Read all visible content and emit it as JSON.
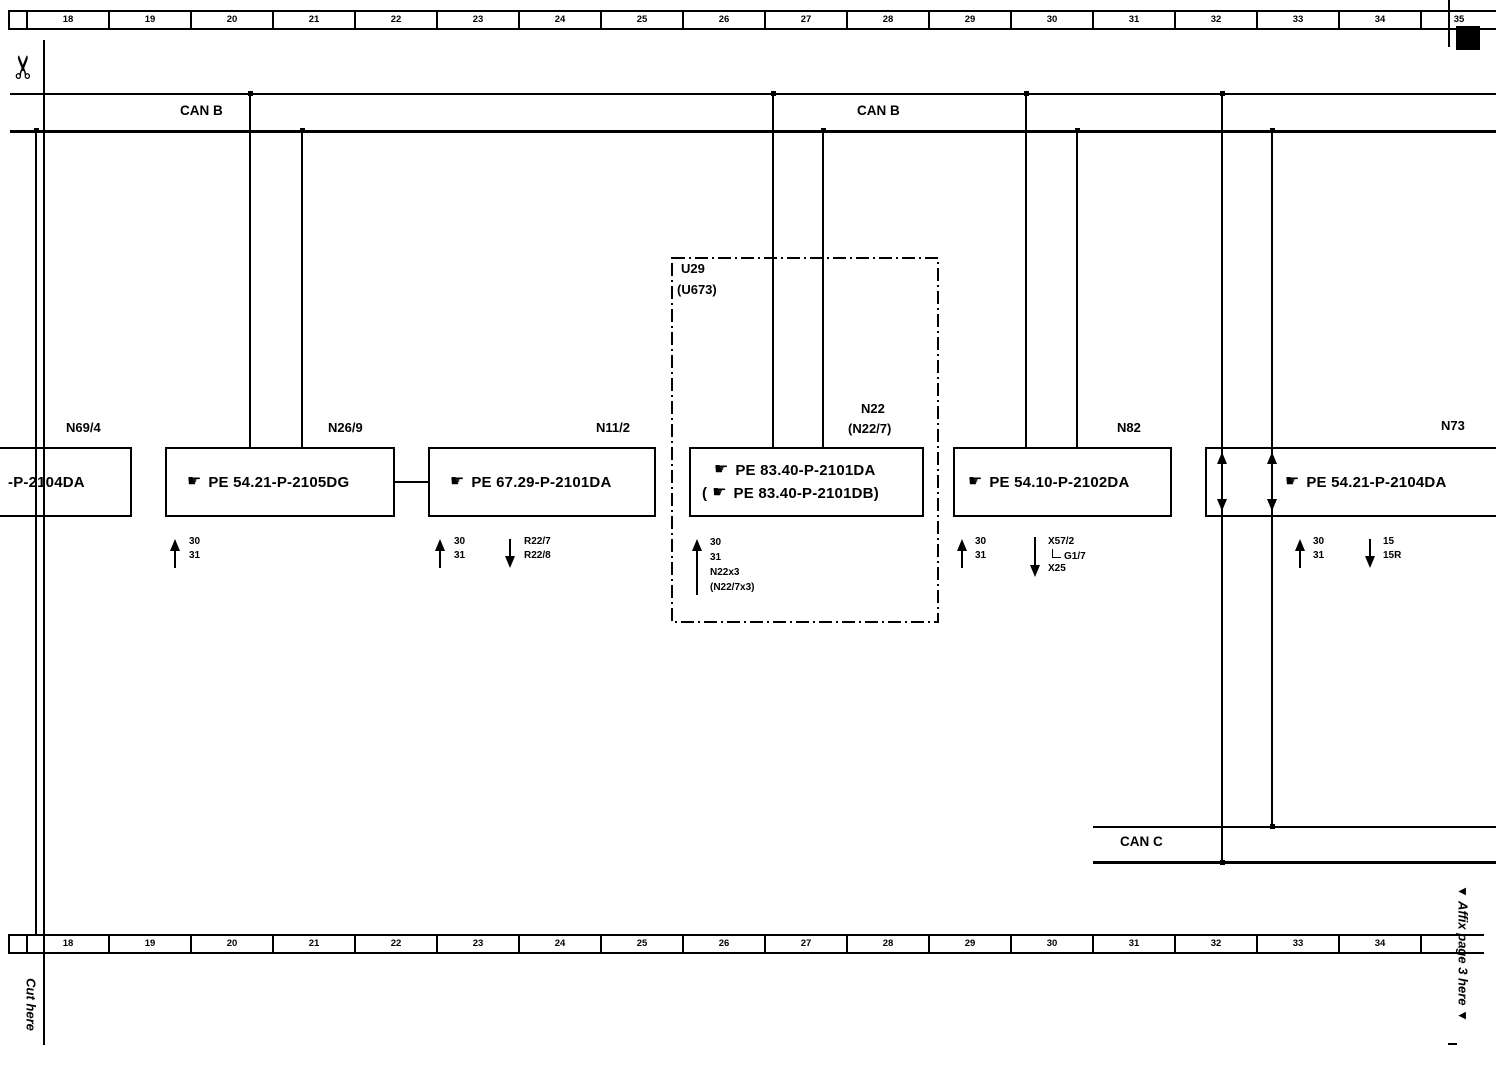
{
  "icons": {
    "hand": "☛",
    "scissors": "✂"
  },
  "ruler_top": {
    "cells": [
      "18",
      "19",
      "20",
      "21",
      "22",
      "23",
      "24",
      "25",
      "26",
      "27",
      "28",
      "29",
      "30",
      "31",
      "32",
      "33",
      "34",
      "35"
    ]
  },
  "ruler_bottom": {
    "cells": [
      "18",
      "19",
      "20",
      "21",
      "22",
      "23",
      "24",
      "25",
      "26",
      "27",
      "28",
      "29",
      "30",
      "31",
      "32",
      "33",
      "34"
    ]
  },
  "bus": {
    "can_b_left": "CAN B",
    "can_b_right": "CAN B",
    "can_c": "CAN C"
  },
  "boxes": {
    "n69_4": {
      "label": "N69/4",
      "text": "-P-2104DA"
    },
    "n26_9": {
      "label": "N26/9",
      "text": "PE 54.21-P-2105DG"
    },
    "n11_2": {
      "label": "N11/2",
      "text": "PE 67.29-P-2101DA"
    },
    "u29": {
      "label": "U29",
      "sublabel": "(U673)"
    },
    "n22": {
      "label": "N22",
      "sublabel": "(N22/7)",
      "line1": "PE 83.40-P-2101DA",
      "line2_open": "(",
      "line2": "PE 83.40-P-2101DB)"
    },
    "n82": {
      "label": "N82",
      "text": "PE 54.10-P-2102DA"
    },
    "n73": {
      "label": "N73",
      "text": "PE 54.21-P-2104DA"
    }
  },
  "arrows": {
    "n26_9": {
      "up": [
        "30",
        "31"
      ]
    },
    "n11_2": {
      "up": [
        "30",
        "31"
      ],
      "down": [
        "R22/7",
        "R22/8"
      ]
    },
    "n22": {
      "up": [
        "30",
        "31",
        "N22x3",
        "(N22/7x3)"
      ]
    },
    "n82": {
      "up": [
        "30",
        "31"
      ],
      "down_1": "X57/2",
      "down_2": "G1/7",
      "down_3": "X25"
    },
    "n73": {
      "up": [
        "30",
        "31"
      ],
      "down": [
        "15",
        "15R"
      ]
    }
  },
  "margins": {
    "cut_here": "Cut here",
    "affix": "▼ Affix page 3 here  ▼"
  }
}
